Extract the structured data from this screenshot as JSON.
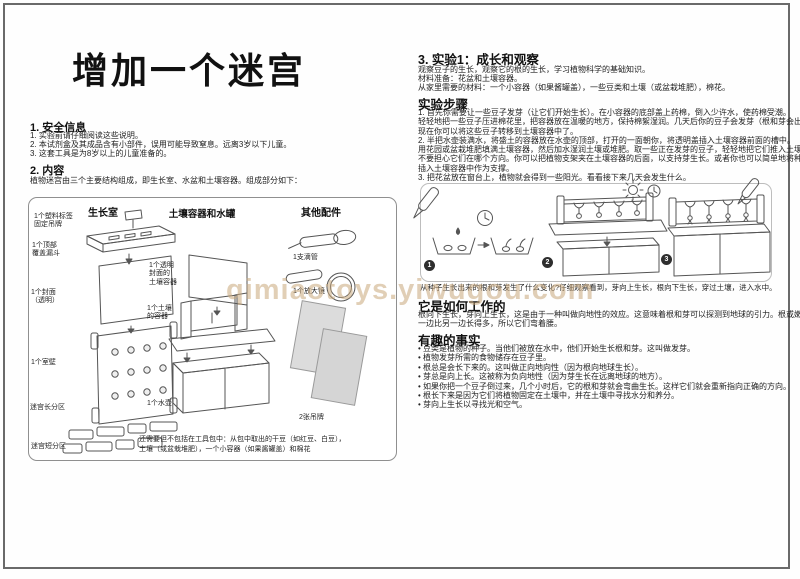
{
  "page": {
    "title": "增加一个迷宫",
    "watermark": "qimiaotoys.yiwugou.com"
  },
  "colors": {
    "watermark": "#c9a87c",
    "ink": "#1c1c1c",
    "diagram_stroke": "#555555",
    "tag_fill": "#d9d9d9"
  },
  "safety": {
    "heading": "1. 安全信息",
    "line1": "1. 实验前请仔细阅读这些说明。",
    "line2": "2. 本试剂盒及其成品含有小部件，误用可能导致窒息。远离3岁以下儿童。",
    "line3": "3. 这套工具是为8岁以上的儿童准备的。"
  },
  "contents": {
    "heading": "2. 内容",
    "intro": "植物迷宫由三个主要结构组成，即生长室、水盆和土壤容器。组成部分如下：",
    "growth_chamber": {
      "title": "生长室",
      "label_tag": "1个塑料标签\n固定吊牌",
      "label_funnel": "1个顶部\n覆盖漏斗",
      "label_cover": "1个封面\n（透明）",
      "label_wall": "1个室壁",
      "label_maze_long": "迷宫长分区",
      "label_maze_short": "迷宫短分区"
    },
    "soil_water": {
      "title": "土壤容器和水罐",
      "label_clear_cover": "1个透明\n封面的\n土壤容器",
      "label_soil_container": "1个土壤\n的容器",
      "label_water_tank": "1个水壶"
    },
    "accessories": {
      "title": "其他配件",
      "label_dropper": "1支滴管",
      "label_magnifier": "1个放大镜",
      "label_tags": "2张吊牌"
    },
    "note_line1": "还需要但不包括在工具包中：从包中取出的干豆（如红豆、白豆），",
    "note_line2": "土壤（或盆栽堆肥），一个小容器（如果酱罐盖）和棉花"
  },
  "experiment": {
    "heading": "3. 实验1：成长和观察",
    "desc1": "观察豆子的生长，观察它的根的生长，学习植物科学的基础知识。",
    "desc2": "材料准备：花盆和土壤容器。",
    "desc3": "从家里需要的材料：一个小容器（如果酱罐盖），一些豆类和土壤（或盆栽堆肥），棉花。",
    "steps_heading": "实验步骤",
    "steps": [
      "1. 首先你需要让一些豆子发芽（让它们开始生长）。在小容器的底部盖上药棉，倒入少许水，使药棉受潮。",
      "轻轻地把一些豆子压进棉花里，把容器放在温暖的地方，保持棉絮湿润。几天后你的豆子会发芽（根和芽会出现）。",
      "现在你可以将这些豆子转移到土壤容器中了。",
      "2. 半把水壶装满水，将盛土的容器放在水壶的顶部，打开的一面朝你，将透明盖插入土壤容器前面的槽中。",
      "用花园或盆栽堆肥填满土壤容器，然后加水湿润土壤或堆肥。取一些正在发芽的豆子，轻轻地把它们推入土壤。",
      "不要担心它们在哪个方向。你可以把植物支架夹在土壤容器的后面，以支持芽生长。或者你也可以简单地将种植室",
      "插入土壤容器中作为支撑。",
      "3. 把花盆放在窗台上，植物就会得到一些阳光。看看接下来几天会发生什么。"
    ],
    "step_numbers": [
      "1",
      "2",
      "3"
    ],
    "caption": "从种子生长出来的根和芽发生了什么变化?仔细观察看到，芽向上生长，根向下生长，穿过土壤，进入水中。"
  },
  "how_it_works": {
    "heading": "它是如何工作的",
    "line1": "根向下生长，芽向上生长，这是由于一种叫做向地性的效应。这意味着根和芽可以探测到地球的引力。根或嫩枝的",
    "line2": "一边比另一边长得多，所以它们弯着腰。"
  },
  "facts": {
    "heading": "有趣的事实",
    "items": [
      "• 豆类是植物的种子。当他们被放在水中，他们开始生长根和芽。这叫做发芽。",
      "• 植物发芽所需的食物储存在豆子里。",
      "• 根总是会长下来的。这叫做正向地向性（因为根向地球生长）。",
      "• 芽总是向上长。这被称为负向地性（因为芽生长在远离地球的地方）。",
      "• 如果你把一个豆子倒过来，几个小时后，它的根和芽就会弯曲生长。这样它们就会重新指向正确的方向。",
      "• 根长下来是因为它们将植物固定在土壤中，并在土壤中寻找水分和养分。",
      "• 芽向上生长以寻找光和空气。"
    ]
  }
}
